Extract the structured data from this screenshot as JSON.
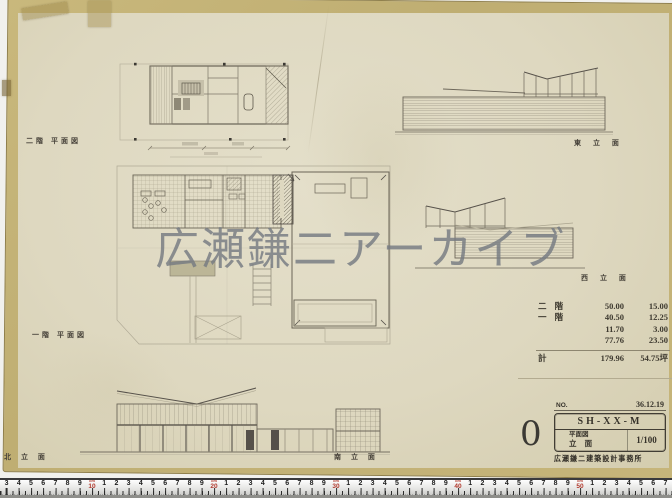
{
  "sheet": {
    "watermark": "広瀬鎌二アーカイブ",
    "stamp_number": "0"
  },
  "drawing_labels": {
    "second_floor_plan": "二階 平面図",
    "first_floor_plan": "一階 平面図",
    "east_elevation": "東 立 面",
    "west_elevation": "西 立 面",
    "south_elevation": "南 立 面",
    "north_elevation": "北 立 面"
  },
  "area_table": {
    "rows": [
      {
        "label": "二 階",
        "sqm": "50.00",
        "tsubo": "15.00"
      },
      {
        "label": "一 階",
        "sqm": "40.50",
        "tsubo": "12.25"
      },
      {
        "label": "",
        "sqm": "11.70",
        "tsubo": "3.00"
      },
      {
        "label": "",
        "sqm": "77.76",
        "tsubo": "23.50"
      }
    ],
    "total": {
      "label": "計",
      "sqm": "179.96",
      "tsubo": "54.75坪"
    }
  },
  "title_block": {
    "no_label": "NO.",
    "date": "36.12.19",
    "code": "SH-XX-M",
    "drawing_type_line1": "平面図",
    "drawing_type_line2": "立 面",
    "scale": "1/100",
    "office_stamp": "広瀬鎌二建築設計事務所"
  },
  "ruler": {
    "unit": "cm",
    "digits": [
      "1",
      "2",
      "3",
      "4",
      "5",
      "6",
      "7",
      "8",
      "9"
    ],
    "decades": [
      "10",
      "20",
      "30",
      "40",
      "50"
    ]
  },
  "colors": {
    "paper": "#ded8c0",
    "paper_edge": "#c3b176",
    "pencil_dark": "#5c5749",
    "watermark_gray": "#767b82",
    "ruler_red": "#b23a2e"
  }
}
